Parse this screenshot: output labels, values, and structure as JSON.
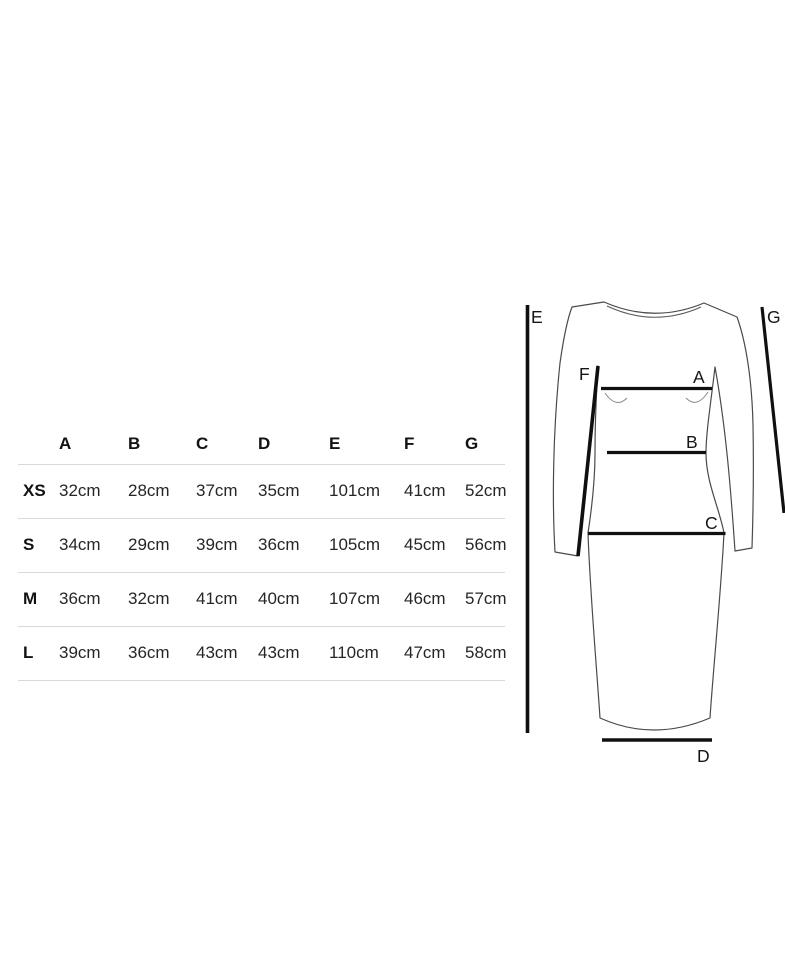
{
  "size_chart": {
    "columns": [
      "A",
      "B",
      "C",
      "D",
      "E",
      "F",
      "G"
    ],
    "rows": [
      {
        "label": "XS",
        "values": [
          "32cm",
          "28cm",
          "37cm",
          "35cm",
          "101cm",
          "41cm",
          "52cm"
        ]
      },
      {
        "label": "S",
        "values": [
          "34cm",
          "29cm",
          "39cm",
          "36cm",
          "105cm",
          "45cm",
          "56cm"
        ]
      },
      {
        "label": "M",
        "values": [
          "36cm",
          "32cm",
          "41cm",
          "40cm",
          "107cm",
          "46cm",
          "57cm"
        ]
      },
      {
        "label": "L",
        "values": [
          "39cm",
          "36cm",
          "43cm",
          "43cm",
          "110cm",
          "47cm",
          "58cm"
        ]
      }
    ]
  },
  "diagram": {
    "labels": {
      "bust": "A",
      "waist": "B",
      "hip": "C",
      "hem": "D",
      "length": "E",
      "sleeve_inner": "F",
      "sleeve_outer": "G"
    }
  },
  "colors": {
    "background": "#ffffff",
    "heading_text": "#121212",
    "value_text": "#262626",
    "divider": "#d9d9d9",
    "measurement_line": "#101010",
    "garment_outline": "#4a4a4a"
  }
}
